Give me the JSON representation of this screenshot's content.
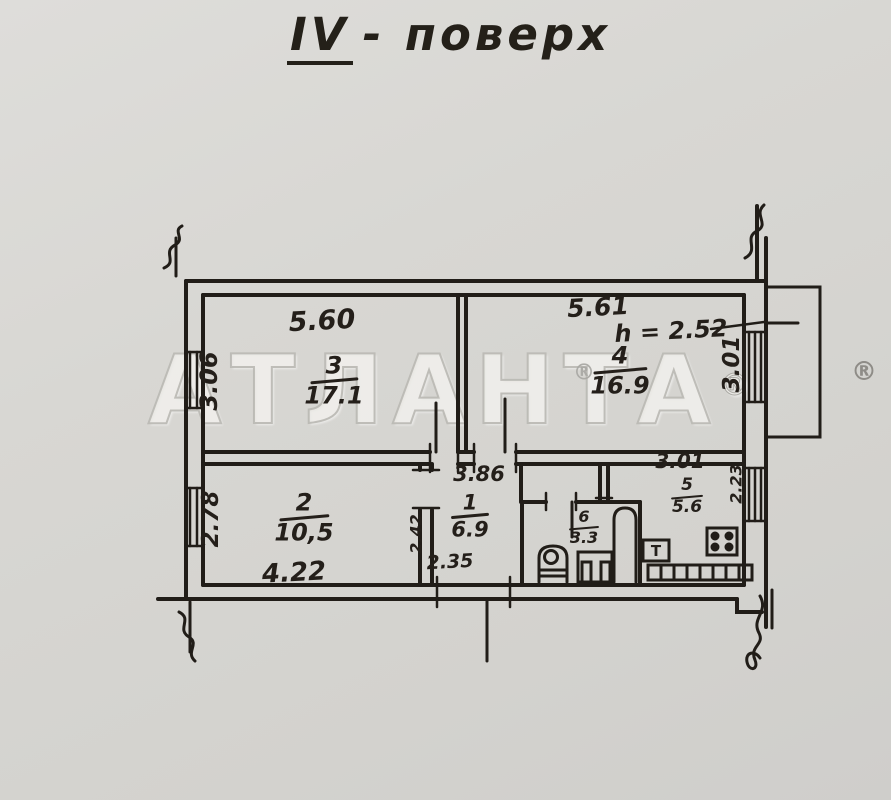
{
  "title": {
    "roman": "IV",
    "text": "- поверх"
  },
  "watermark": {
    "text": "АТЛАНТА",
    "reg": "®"
  },
  "rooms": {
    "r3": {
      "num": "3",
      "area": "17.1"
    },
    "r4": {
      "num": "4",
      "area": "16.9"
    },
    "r2": {
      "num": "2",
      "area": "10,5"
    },
    "r1": {
      "num": "1",
      "area": "6.9"
    },
    "r6": {
      "num": "6",
      "area": "3.3"
    },
    "r5": {
      "num": "5",
      "area": "5.6"
    }
  },
  "dims": {
    "r3_width": "5.60",
    "r3_height": "3.06",
    "r4_width": "5.61",
    "r4_ceiling": "h = 2.52",
    "r4_height": "3.01",
    "r2_height": "2.78",
    "r2_width": "4.22",
    "r1_width": "3.86",
    "r1_height": "2.42",
    "r1_bottom": "2.35",
    "r5_width": "3.01",
    "r5_height": "2.23"
  },
  "kitchen": {
    "table": "T"
  }
}
